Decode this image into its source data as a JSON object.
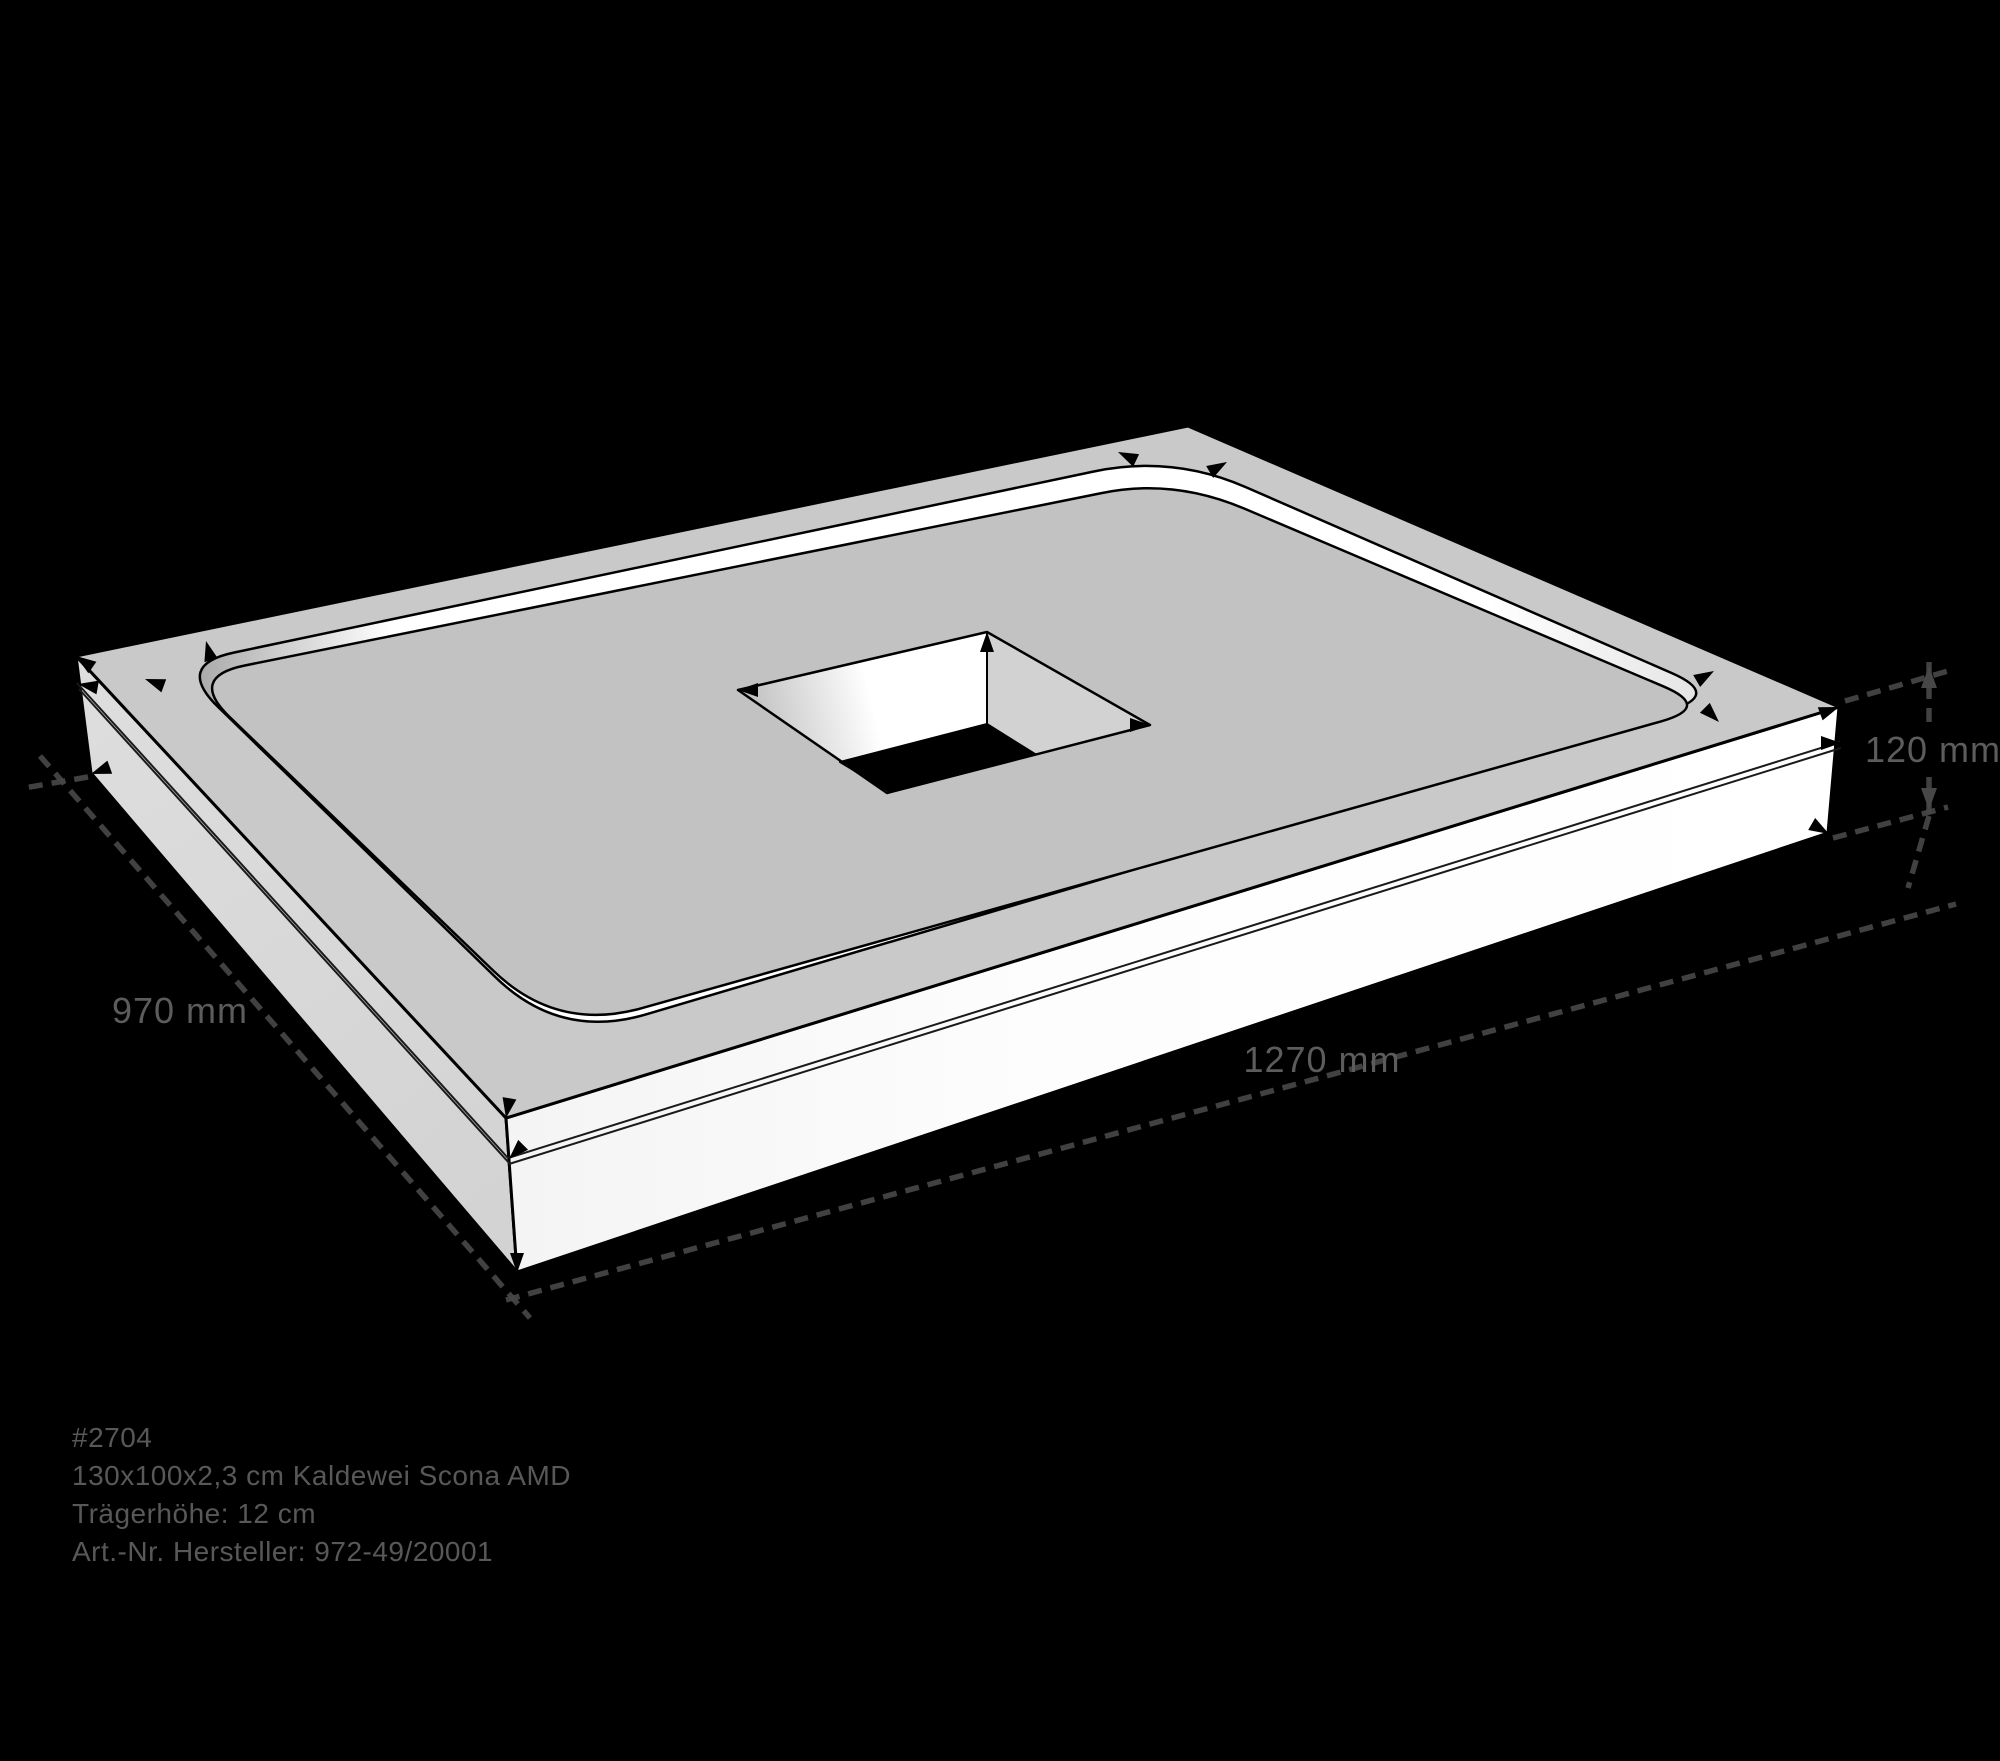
{
  "scene": {
    "type": "technical-product-drawing",
    "subject": "shower tray support block with central drain cutout, isometric view",
    "background_color": "#000000"
  },
  "dimensions": {
    "depth_label": "970 mm",
    "width_label": "1270 mm",
    "height_label": "120 mm"
  },
  "product_info": {
    "line1": "#2704",
    "line2": "130x100x2,3 cm Kaldewei Scona AMD",
    "line3": "Trägerhöhe: 12 cm",
    "line4": "Art.-Nr. Hersteller: 972-49/20001"
  },
  "colors": {
    "top_face": "#c9c9c9",
    "recess_floor": "#c2c2c2",
    "recess_wall": "#ffffff",
    "left_side_face": "#d7d7d7",
    "front_side_face": "#fbfbfb",
    "hole_bottom": "#000000",
    "edge_line": "#000000",
    "dimension_line": "#474747",
    "label_text": "#5c5c5c",
    "info_text": "#585858"
  },
  "icons": {
    "corner_marker": "small black arrowhead at model corners",
    "dimension_arrow": "arrowhead on height dimension line"
  }
}
